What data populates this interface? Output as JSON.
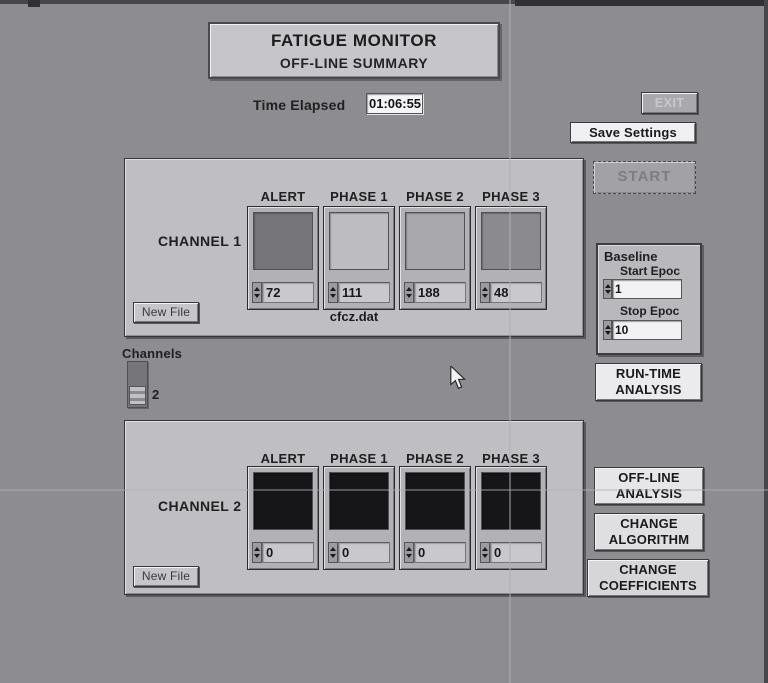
{
  "title": {
    "line1": "FATIGUE MONITOR",
    "line2": "OFF-LINE SUMMARY"
  },
  "time_elapsed": {
    "label": "Time Elapsed",
    "value": "01:06:55"
  },
  "buttons": {
    "exit": "EXIT",
    "save_settings": "Save Settings",
    "start": "START",
    "run_time": "RUN-TIME\nANALYSIS",
    "off_line": "OFF-LINE\nANALYSIS",
    "change_algorithm": "CHANGE\nALGORITHM",
    "change_coefficients": "CHANGE\nCOEFFICIENTS",
    "new_file": "New File"
  },
  "column_headers": [
    "ALERT",
    "PHASE 1",
    "PHASE 2",
    "PHASE 3"
  ],
  "channel1": {
    "label": "CHANNEL 1",
    "file": "cfcz.dat",
    "values": [
      "72",
      "111",
      "188",
      "48"
    ],
    "box_colors": [
      "#76767a",
      "#bdbdc1",
      "#a9a9ad",
      "#8b8b8f"
    ]
  },
  "channel2": {
    "label": "CHANNEL 2",
    "values": [
      "0",
      "0",
      "0",
      "0"
    ],
    "box_colors": [
      "#161618",
      "#161618",
      "#161618",
      "#161618"
    ]
  },
  "channels_selector": {
    "label": "Channels",
    "value": "2"
  },
  "baseline": {
    "title": "Baseline",
    "start_label": "Start Epoc",
    "start_value": "1",
    "stop_label": "Stop Epoc",
    "stop_value": "10"
  },
  "colors": {
    "page_bg": "#8d8d91",
    "panel_bg": "#bfbfc3",
    "exit_bg": "#a9a9ad",
    "exit_text": "#c8c8cc",
    "save_settings_bg": "#f0f0f2",
    "start_bg": "#a2a2a6",
    "start_text": "#7e7e82",
    "run_time_bg": "#ebebed",
    "off_line_bg": "#e6e6e8",
    "change_algorithm_bg": "#dfdfe1",
    "change_coefficients_bg": "#d6d6d8"
  }
}
